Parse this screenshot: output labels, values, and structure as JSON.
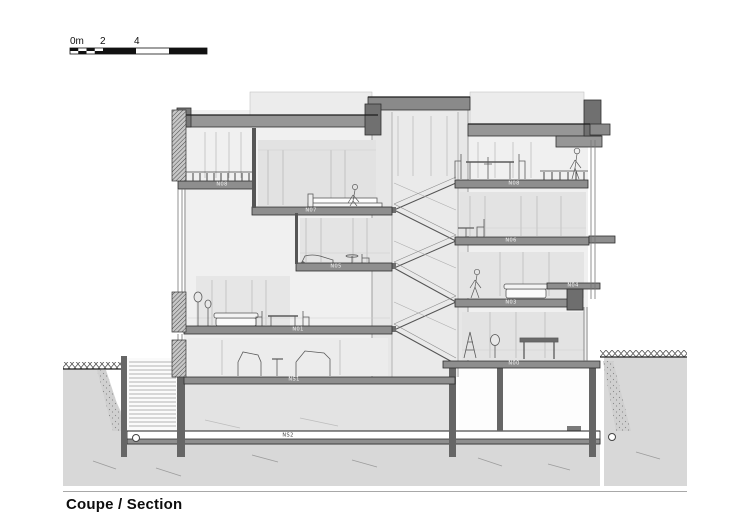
{
  "title": "Coupe / Section",
  "scale_bar": {
    "label_0": "0m",
    "label_2": "2",
    "label_4": "4"
  },
  "floors": {
    "n08_left": "N08",
    "n07": "N07",
    "n05": "N05",
    "n01": "N01",
    "ns1": "NS1",
    "ns2": "NS2",
    "n08_right": "N08",
    "n06": "N06",
    "n04": "N04",
    "n03": "N03",
    "n00": "N00"
  }
}
